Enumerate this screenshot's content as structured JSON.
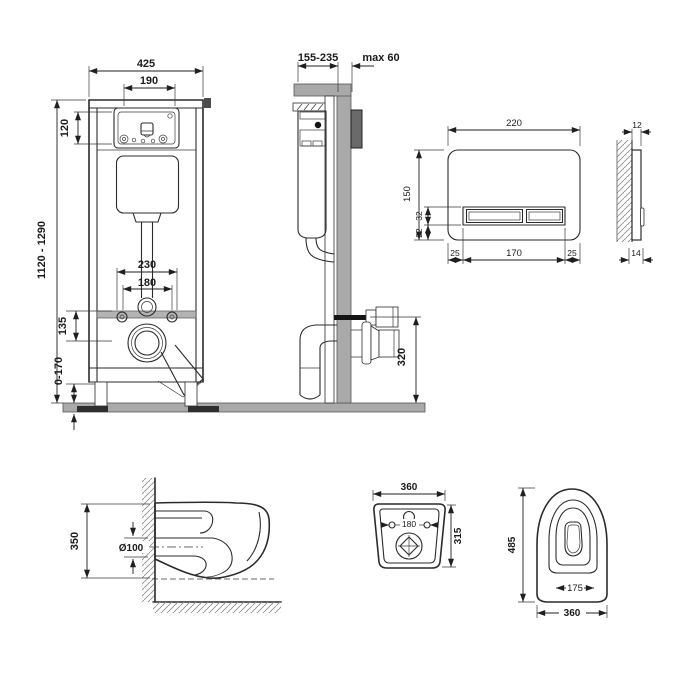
{
  "views": {
    "frame_front": {
      "width": "425",
      "cutout_width": "190",
      "cutout_height": "120",
      "height_range": "1120 - 1290",
      "fixing_span": "230",
      "stud_spacing": "180",
      "drain_offset": "135",
      "leg_adjustment": "0-170"
    },
    "frame_side": {
      "depth_range": "155-235",
      "wall_thickness_max": "max 60",
      "outlet_height": "320"
    },
    "flush_plate_front": {
      "width": "220",
      "height": "150",
      "button_height": "32",
      "button_bottom_offset": "22",
      "left_margin": "25",
      "button_span": "170",
      "right_margin": "25"
    },
    "flush_plate_side": {
      "thickness_top": "12",
      "thickness_bottom": "14"
    },
    "bowl_side": {
      "height": "350",
      "outlet_diameter": "Ø100"
    },
    "bowl_rear": {
      "width": "360",
      "height": "315",
      "stud_spacing": "180"
    },
    "bowl_plan": {
      "depth": "485",
      "seat_span": "175",
      "width": "360"
    }
  },
  "colors": {
    "line": "#2b2b2b",
    "masonry_gray": "#a9a9a9",
    "fitting_dark": "#6a6a6a",
    "hatch": "#8f8f8f",
    "background": "#ffffff"
  }
}
